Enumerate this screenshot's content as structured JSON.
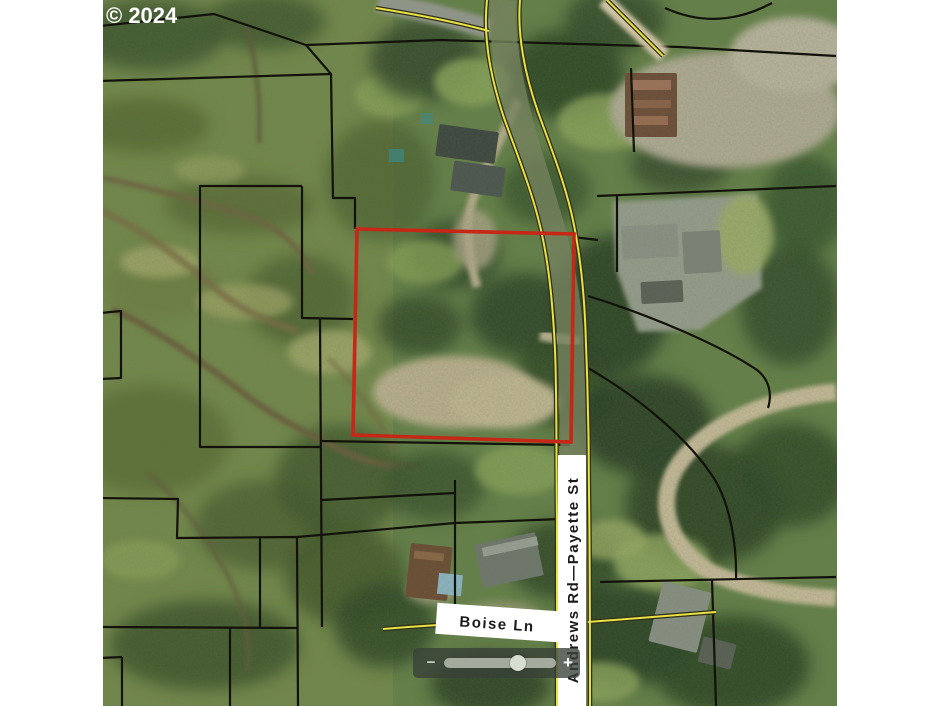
{
  "map": {
    "copyright": "© 2024",
    "labels": {
      "vertical_road": "Andrews Rd—Payette St",
      "horizontal_road": "Boise Ln"
    },
    "colors": {
      "parcel_outline": "#c62717",
      "boundary_line": "#12120a",
      "road_centerline": "#e8e242",
      "label_band": "#ffffff"
    }
  },
  "zoom_control": {
    "zoom_out_label": "−",
    "zoom_in_label": "+",
    "thumb_position_percent": 66
  }
}
